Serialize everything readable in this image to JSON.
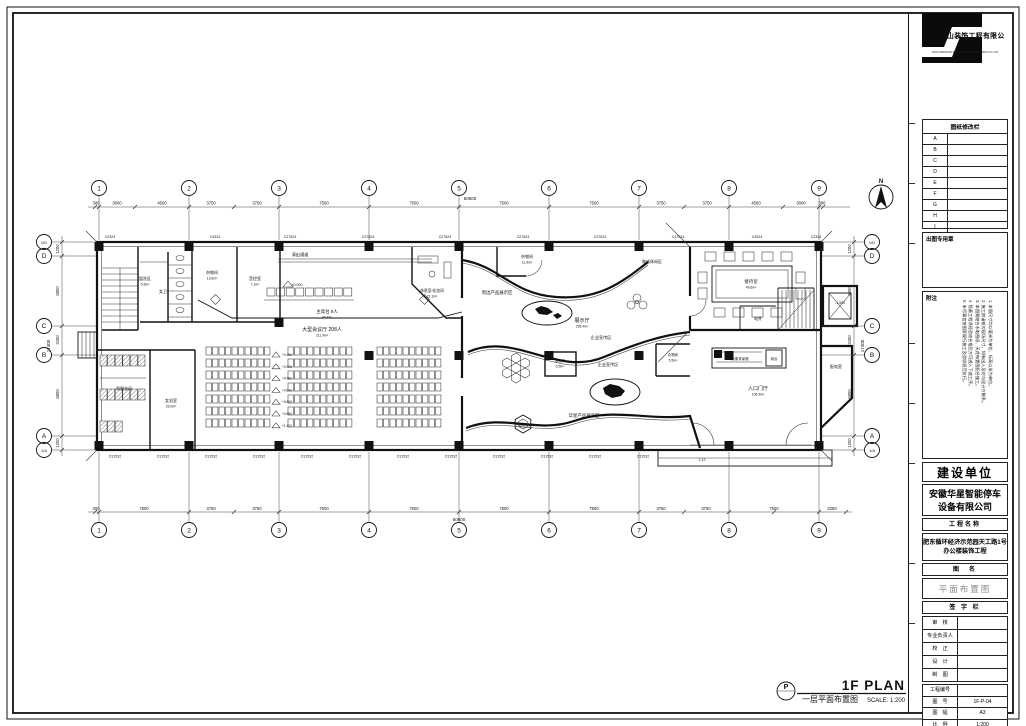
{
  "sheet": {
    "title_zh": "一层平面布置图",
    "title_en": "1F PLAN",
    "scale_label": "SCALE: 1:200",
    "p_symbol": "P",
    "north_label": "N"
  },
  "panel": {
    "logo_company": "安徽半山装饰工程有限公司",
    "logo_company_en": "ANHUI BANSHAN DECORATION ENGINEERING CO.,LTD",
    "revision_title": "图纸修改栏",
    "revision_rows": [
      "A",
      "B",
      "C",
      "D",
      "E",
      "F",
      "G",
      "H",
      "I"
    ],
    "stamp_label": "出图专用章",
    "notes_title": "附注",
    "notes": [
      "1. 本图尺寸均以毫米为单位，标高以米为单位。",
      "2. 施工前请核对现场尺寸，如有出入及时与设计方联系。",
      "3. 本图需结合水电图纸、天花布置图配合施工。",
      "4. 隐蔽工程须经验收合格后方可进入下道工序。",
      "5. 未尽事宜按国家现行施工及验收规范执行。"
    ],
    "client_header": "建设单位",
    "client_name_line1": "安徽华星智能停车",
    "client_name_line2": "设备有限公司",
    "project_header": "工程名称",
    "project_name_line1": "肥东循环经济示范园天工路1号",
    "project_name_line2": "办公楼装饰工程",
    "drawing_header": "图　名",
    "drawing_name": "平面布置图",
    "signature_header": "签 字 栏",
    "signature_rows": [
      "审　核",
      "专业负责人",
      "校　正",
      "设　计",
      "制　图"
    ],
    "project_no_label": "工程编号",
    "meta_rows": [
      {
        "label": "图　号",
        "value": "1F-P-04"
      },
      {
        "label": "图　幅",
        "value": "A3"
      },
      {
        "label": "比　例",
        "value": "1:200"
      },
      {
        "label": "日　期",
        "value": "2021.05.28"
      }
    ]
  },
  "plan": {
    "totals": {
      "w": "60600",
      "h": "17400"
    },
    "grid_cols": [
      {
        "x": 99,
        "v": "1"
      },
      {
        "x": 189,
        "v": "2"
      },
      {
        "x": 279,
        "v": "3"
      },
      {
        "x": 369,
        "v": "4"
      },
      {
        "x": 459,
        "v": "5"
      },
      {
        "x": 549,
        "v": "6"
      },
      {
        "x": 639,
        "v": "7"
      },
      {
        "x": 729,
        "v": "8"
      },
      {
        "x": 819,
        "v": "9"
      }
    ],
    "grid_rows": [
      {
        "y": 242,
        "v": "1/D"
      },
      {
        "y": 256,
        "v": "D"
      },
      {
        "y": 326,
        "v": "C"
      },
      {
        "y": 355,
        "v": "B"
      },
      {
        "y": 436,
        "v": "A"
      },
      {
        "y": 450,
        "v": "1/A"
      }
    ],
    "dims_top": [
      {
        "x": 96,
        "v": "300"
      },
      {
        "x": 117,
        "v": "3000"
      },
      {
        "x": 162,
        "v": "4500"
      },
      {
        "x": 211,
        "v": "3750"
      },
      {
        "x": 257,
        "v": "3750"
      },
      {
        "x": 324,
        "v": "7500"
      },
      {
        "x": 414,
        "v": "7500"
      },
      {
        "x": 504,
        "v": "7500"
      },
      {
        "x": 594,
        "v": "7500"
      },
      {
        "x": 661,
        "v": "3750"
      },
      {
        "x": 707,
        "v": "3750"
      },
      {
        "x": 756,
        "v": "4500"
      },
      {
        "x": 801,
        "v": "3000"
      },
      {
        "x": 822,
        "v": "300"
      }
    ],
    "dims_bottom": [
      {
        "x": 96,
        "v": "300"
      },
      {
        "x": 144,
        "v": "7500"
      },
      {
        "x": 211,
        "v": "3750"
      },
      {
        "x": 257,
        "v": "3750"
      },
      {
        "x": 324,
        "v": "7500"
      },
      {
        "x": 414,
        "v": "7500"
      },
      {
        "x": 504,
        "v": "7500"
      },
      {
        "x": 594,
        "v": "7500"
      },
      {
        "x": 661,
        "v": "3750"
      },
      {
        "x": 706,
        "v": "3750"
      },
      {
        "x": 774,
        "v": "7500"
      },
      {
        "x": 832,
        "v": "2250"
      }
    ],
    "dims_left": [
      {
        "y": 249,
        "v": "1200"
      },
      {
        "y": 291,
        "v": "5800"
      },
      {
        "y": 340,
        "v": "2400"
      },
      {
        "y": 394,
        "v": "6800"
      },
      {
        "y": 443,
        "v": "1200"
      }
    ],
    "windows_top": [
      {
        "x": 110,
        "v": "C2324"
      },
      {
        "x": 215,
        "v": "C4324"
      },
      {
        "x": 290,
        "v": "C27524"
      },
      {
        "x": 368,
        "v": "C27524"
      },
      {
        "x": 445,
        "v": "C27524"
      },
      {
        "x": 523,
        "v": "C27524"
      },
      {
        "x": 600,
        "v": "C27524"
      },
      {
        "x": 678,
        "v": "C27524"
      },
      {
        "x": 757,
        "v": "C4324"
      },
      {
        "x": 816,
        "v": "C2324"
      }
    ],
    "windows_bottom": [
      {
        "x": 115,
        "v": "C31532"
      },
      {
        "x": 163,
        "v": "C31532"
      },
      {
        "x": 211,
        "v": "C31532"
      },
      {
        "x": 259,
        "v": "C31532"
      },
      {
        "x": 307,
        "v": "C31532"
      },
      {
        "x": 355,
        "v": "C31532"
      },
      {
        "x": 403,
        "v": "C31532"
      },
      {
        "x": 451,
        "v": "C31532"
      },
      {
        "x": 499,
        "v": "C31532"
      },
      {
        "x": 547,
        "v": "C31532"
      },
      {
        "x": 595,
        "v": "C31532"
      },
      {
        "x": 643,
        "v": "C31532"
      }
    ],
    "rooms": [
      {
        "n": "盥洗区",
        "a": "5.5m²",
        "x": 145,
        "y": 280,
        "s": 4
      },
      {
        "n": "女卫",
        "x": 163,
        "y": 293,
        "s": 4
      },
      {
        "n": "杂物间",
        "a": "13.6m²",
        "x": 212,
        "y": 274,
        "s": 4
      },
      {
        "n": "音控室",
        "a": "7.1m²",
        "x": 255,
        "y": 280,
        "s": 4
      },
      {
        "n": "演出通道",
        "x": 300,
        "y": 256,
        "s": 4.2
      },
      {
        "n": "主席台 9人",
        "a": "46.4m²",
        "x": 327,
        "y": 313,
        "s": 4.4
      },
      {
        "n": "大型会议厅 208人",
        "a": "211.9m²",
        "x": 322,
        "y": 331,
        "s": 5
      },
      {
        "n": "休息室/化妆间",
        "a": "21.1m²",
        "x": 432,
        "y": 292,
        "s": 3.8
      },
      {
        "n": "杂物间",
        "a": "11.9m²",
        "x": 527,
        "y": 258,
        "s": 4
      },
      {
        "n": "周边产品展示区",
        "x": 497,
        "y": 294,
        "s": 4.4
      },
      {
        "n": "咖啡休闲区",
        "x": 652,
        "y": 263,
        "s": 4
      },
      {
        "n": "展示厅",
        "a": "295.4m²",
        "x": 582,
        "y": 322,
        "s": 5
      },
      {
        "n": "企业宣传区",
        "x": 601,
        "y": 339,
        "s": 4.2
      },
      {
        "n": "企业宣传区",
        "x": 608,
        "y": 366,
        "s": 4.2
      },
      {
        "n": "杂物间",
        "a": "5.5m²",
        "x": 560,
        "y": 362,
        "s": 3.4
      },
      {
        "n": "杂物间",
        "a": "5.5m²",
        "x": 673,
        "y": 356,
        "s": 3.4
      },
      {
        "n": "华星产品展示区",
        "x": 584,
        "y": 417,
        "s": 4.4
      },
      {
        "n": "接待室",
        "a": "49.6m²",
        "x": 751,
        "y": 283,
        "s": 4.4
      },
      {
        "n": "电井",
        "x": 758,
        "y": 320,
        "s": 4
      },
      {
        "n": "配电室",
        "x": 836,
        "y": 368,
        "s": 4
      },
      {
        "n": "形象背景墙",
        "x": 740,
        "y": 360,
        "s": 3.4
      },
      {
        "n": "前台",
        "x": 774,
        "y": 360,
        "s": 3.4
      },
      {
        "n": "入口门厅",
        "a": "106.9m²",
        "x": 758,
        "y": 390,
        "s": 5
      },
      {
        "n": "男更衣间",
        "x": 124,
        "y": 390,
        "s": 4
      },
      {
        "n": "女浴室",
        "a": "23.0m²",
        "x": 171,
        "y": 402,
        "s": 4
      },
      {
        "n": "产品展示台",
        "x": 523,
        "y": 426,
        "s": 2.8
      }
    ],
    "elevations": [
      "+0.160",
      "+0.320",
      "+0.480",
      "+0.640",
      "+0.800",
      "+0.960",
      "+1.120"
    ],
    "levels": [
      {
        "x": 297,
        "y": 286,
        "v": "±0.000"
      },
      {
        "x": 840,
        "y": 304,
        "v": "-1.500"
      },
      {
        "x": 702,
        "y": 461,
        "v": "1:12"
      }
    ]
  }
}
